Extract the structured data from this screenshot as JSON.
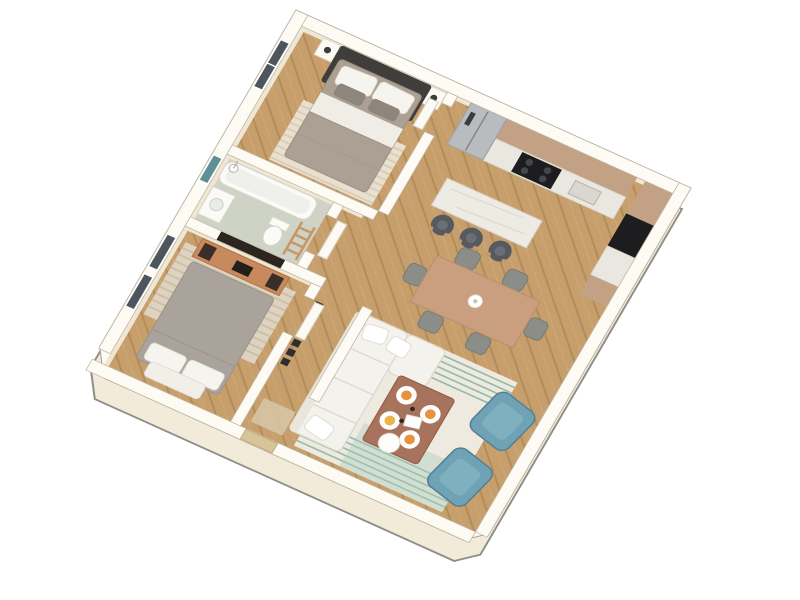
{
  "scene": {
    "type": "3d-isometric-floor-plan-render",
    "subject": "one-bedroom-plus-second-bedroom apartment, bird's-eye 3/4 view, white background, no visible text",
    "palette": {
      "background": "#ffffff",
      "wall_top": "#fdfbf3",
      "wall_face": "#f2ebd9",
      "wall_shade": "#efe7d3",
      "outline": "#8f8e88",
      "wood_floor": "#c79f6c",
      "wood_plank_line": "#b28c59",
      "bathroom_floor": "#ced3c6",
      "cabinet_tan": "#c2a184",
      "counter_marble": "#e9e7e0",
      "appliance_black": "#1d1d1f",
      "fridge_steel": "#b9bcbf",
      "sofa_white": "#f4f2ec",
      "armchair_teal": "#6fa2b4",
      "armchair_teal_shade": "#527f92",
      "coffee_table_wood": "#a8735c",
      "dining_table_wood": "#c99f7f",
      "chair_gray": "#8a8d88",
      "stool_charcoal": "#565a60",
      "bed1_duvet": "#aba093",
      "bed2_duvet": "#a9a39b",
      "headboard_charcoal": "#3f3e3c",
      "pillow_white": "#f6f4ef",
      "rug_cream": "#eeeae0",
      "rug_stripe_green": "#86b3a2",
      "bedroom_rug_beige": "#e9e0cf",
      "tv_dark": "#2c2520",
      "tv_stand_wood": "#c8895c",
      "door_leaf_white": "#fbfaf4",
      "entry_door_tan": "#d9c49a",
      "window_glass_dark": "#4d565e",
      "bathroom_window_teal": "#5f9098",
      "food_orange": "#e8923f"
    },
    "rooms": [
      {
        "id": "bedroom-1",
        "position": "top",
        "furniture": [
          "double-bed-dark-headboard",
          "2-white-nightstands",
          "7-wall-picture-frames",
          "striped-cream-rug",
          "window-nw"
        ]
      },
      {
        "id": "bathroom",
        "position": "left-middle",
        "furniture": [
          "bathtub",
          "shower-fixture",
          "toilet",
          "vanity-sink",
          "wood-towel-ladder",
          "teal-window"
        ]
      },
      {
        "id": "bedroom-2",
        "position": "lower-left",
        "furniture": [
          "double-bed-gray",
          "wood-tv-stand-with-speakers",
          "wall-tv",
          "striped-beige-rug",
          "2-windows-nw"
        ]
      },
      {
        "id": "kitchen",
        "position": "top-right",
        "furniture": [
          "tan-upper-cabinets",
          "marble-counter",
          "stainless-fridge",
          "black-cooktop",
          "tall-tan-cabinets",
          "black-built-in-oven",
          "white-breakfast-bar",
          "3-charcoal-stools"
        ]
      },
      {
        "id": "dining-area",
        "position": "center-right",
        "furniture": [
          "wood-dining-table",
          "6-gray-chairs",
          "white-vase"
        ]
      },
      {
        "id": "living-room",
        "position": "bottom-center",
        "furniture": [
          "white-l-sofa",
          "wood-coffee-table",
          "4-plates-with-food",
          "white-tray",
          "2-teal-armchairs",
          "cream-rug-green-stripes"
        ]
      },
      {
        "id": "entry-hall",
        "position": "bottom-left",
        "furniture": [
          "black-slat-wall-rack",
          "tan-entry-door",
          "beige-doormat"
        ]
      }
    ],
    "counts": {
      "picture_frames": 7,
      "bar_stools": 3,
      "dining_chairs": 6,
      "teal_armchairs": 2,
      "plates_with_food": 4,
      "windows_dark": 3,
      "windows_teal": 1
    }
  }
}
